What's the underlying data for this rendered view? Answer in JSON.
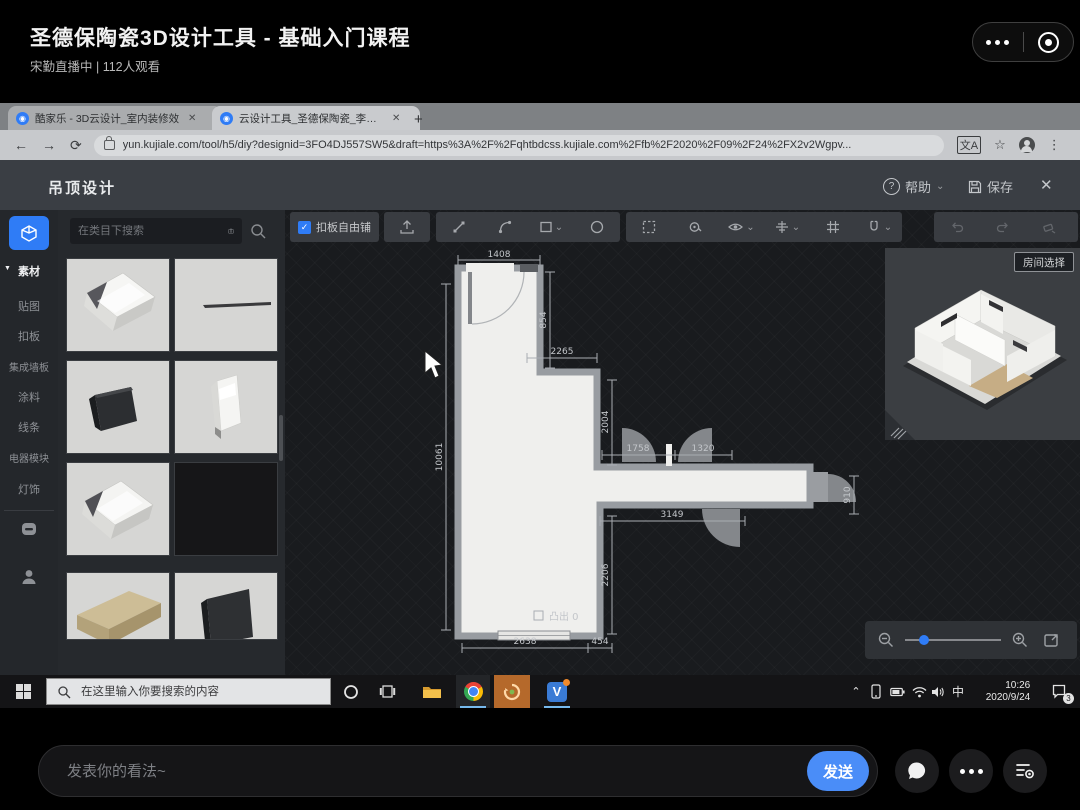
{
  "player": {
    "title": "圣德保陶瓷3D设计工具 - 基础入门课程",
    "subtitle": "宋勤直播中 | 112人观看"
  },
  "browser": {
    "tab1_label": "酷家乐 - 3D云设计_室内装修效",
    "tab2_label": "云设计工具_圣德保陶瓷_李凡-保",
    "url": "yun.kujiale.com/tool/h5/diy?designid=3FO4DJ557SW5&draft=https%3A%2F%2Fqhtbdcss.kujiale.com%2Ffb%2F2020%2F09%2F24%2FX2v2Wgpv..."
  },
  "tool": {
    "title": "吊顶设计",
    "help_label": "帮助",
    "save_label": "保存",
    "search_placeholder": "在类目下搜索",
    "freelay_checkbox_label": "扣板自由铺",
    "room_select_label": "房间选择",
    "protrude_label": "凸出 0",
    "pagination_current": "1",
    "pagination_total": "/250 页",
    "accent_color": "#2f7cf6",
    "sidebar_items": [
      {
        "label": "素材"
      },
      {
        "label": "贴图"
      },
      {
        "label": "扣板"
      },
      {
        "label": "集成墙板"
      },
      {
        "label": "涂料"
      },
      {
        "label": "线条"
      },
      {
        "label": "电器模块"
      },
      {
        "label": "灯饰"
      }
    ],
    "materials": [
      {
        "name": "crown-molding"
      },
      {
        "name": "thin-line-molding"
      },
      {
        "name": "dark-flat-panel"
      },
      {
        "name": "white-baseboard"
      },
      {
        "name": "crown-molding-alt"
      },
      {
        "name": "black-swatch"
      },
      {
        "name": "wood-plank"
      },
      {
        "name": "dark-board"
      }
    ],
    "dims": {
      "top": "1408",
      "right_upper": "854",
      "step": "2265",
      "mid_right": "2004",
      "left": "10061",
      "arm_top_a": "1758",
      "arm_top_b": "1320",
      "arm_end": "910",
      "arm_bottom": "3149",
      "lower_right": "2206",
      "bottom_a": "2638",
      "bottom_b": "454"
    }
  },
  "taskbar": {
    "search_placeholder": "在这里输入你要搜索的内容",
    "ime": "中",
    "time": "10:26",
    "date": "2020/9/24",
    "notif_badge": "3"
  },
  "comment": {
    "placeholder": "发表你的看法~",
    "send_label": "发送"
  },
  "icons": {
    "minimize": "—",
    "restore": "▢",
    "close": "✕",
    "plus": "+",
    "back": "←",
    "forward": "→",
    "reload": "⟳",
    "menu": "⋮",
    "star": "☆",
    "caret_down": "▼",
    "chevron_down": "⌄",
    "collapse": "◀",
    "prev": "◀",
    "next": "▶",
    "tray_up": "⌃",
    "help_q": "?",
    "check": "✓"
  }
}
